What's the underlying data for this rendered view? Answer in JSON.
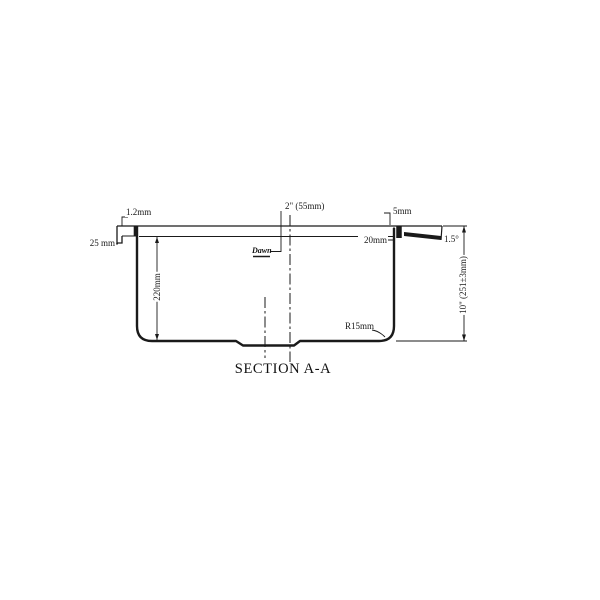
{
  "drawing": {
    "view_title": "SECTION A-A",
    "logo_text": "Dawn",
    "line_color": "#1a1a1a",
    "background_color": "#ffffff",
    "dimensions": {
      "material_thickness": "1.2mm",
      "rim_lip_height": "25 mm",
      "bowl_inner_depth": "220mm",
      "drain_offset": "2\" (55mm)",
      "rim_step": "5mm",
      "rim_ledge_width": "20mm",
      "rim_slope_angle": "1.5°",
      "overall_depth": "10\" (251±3mm)",
      "bottom_corner_radius": "R15mm"
    }
  }
}
